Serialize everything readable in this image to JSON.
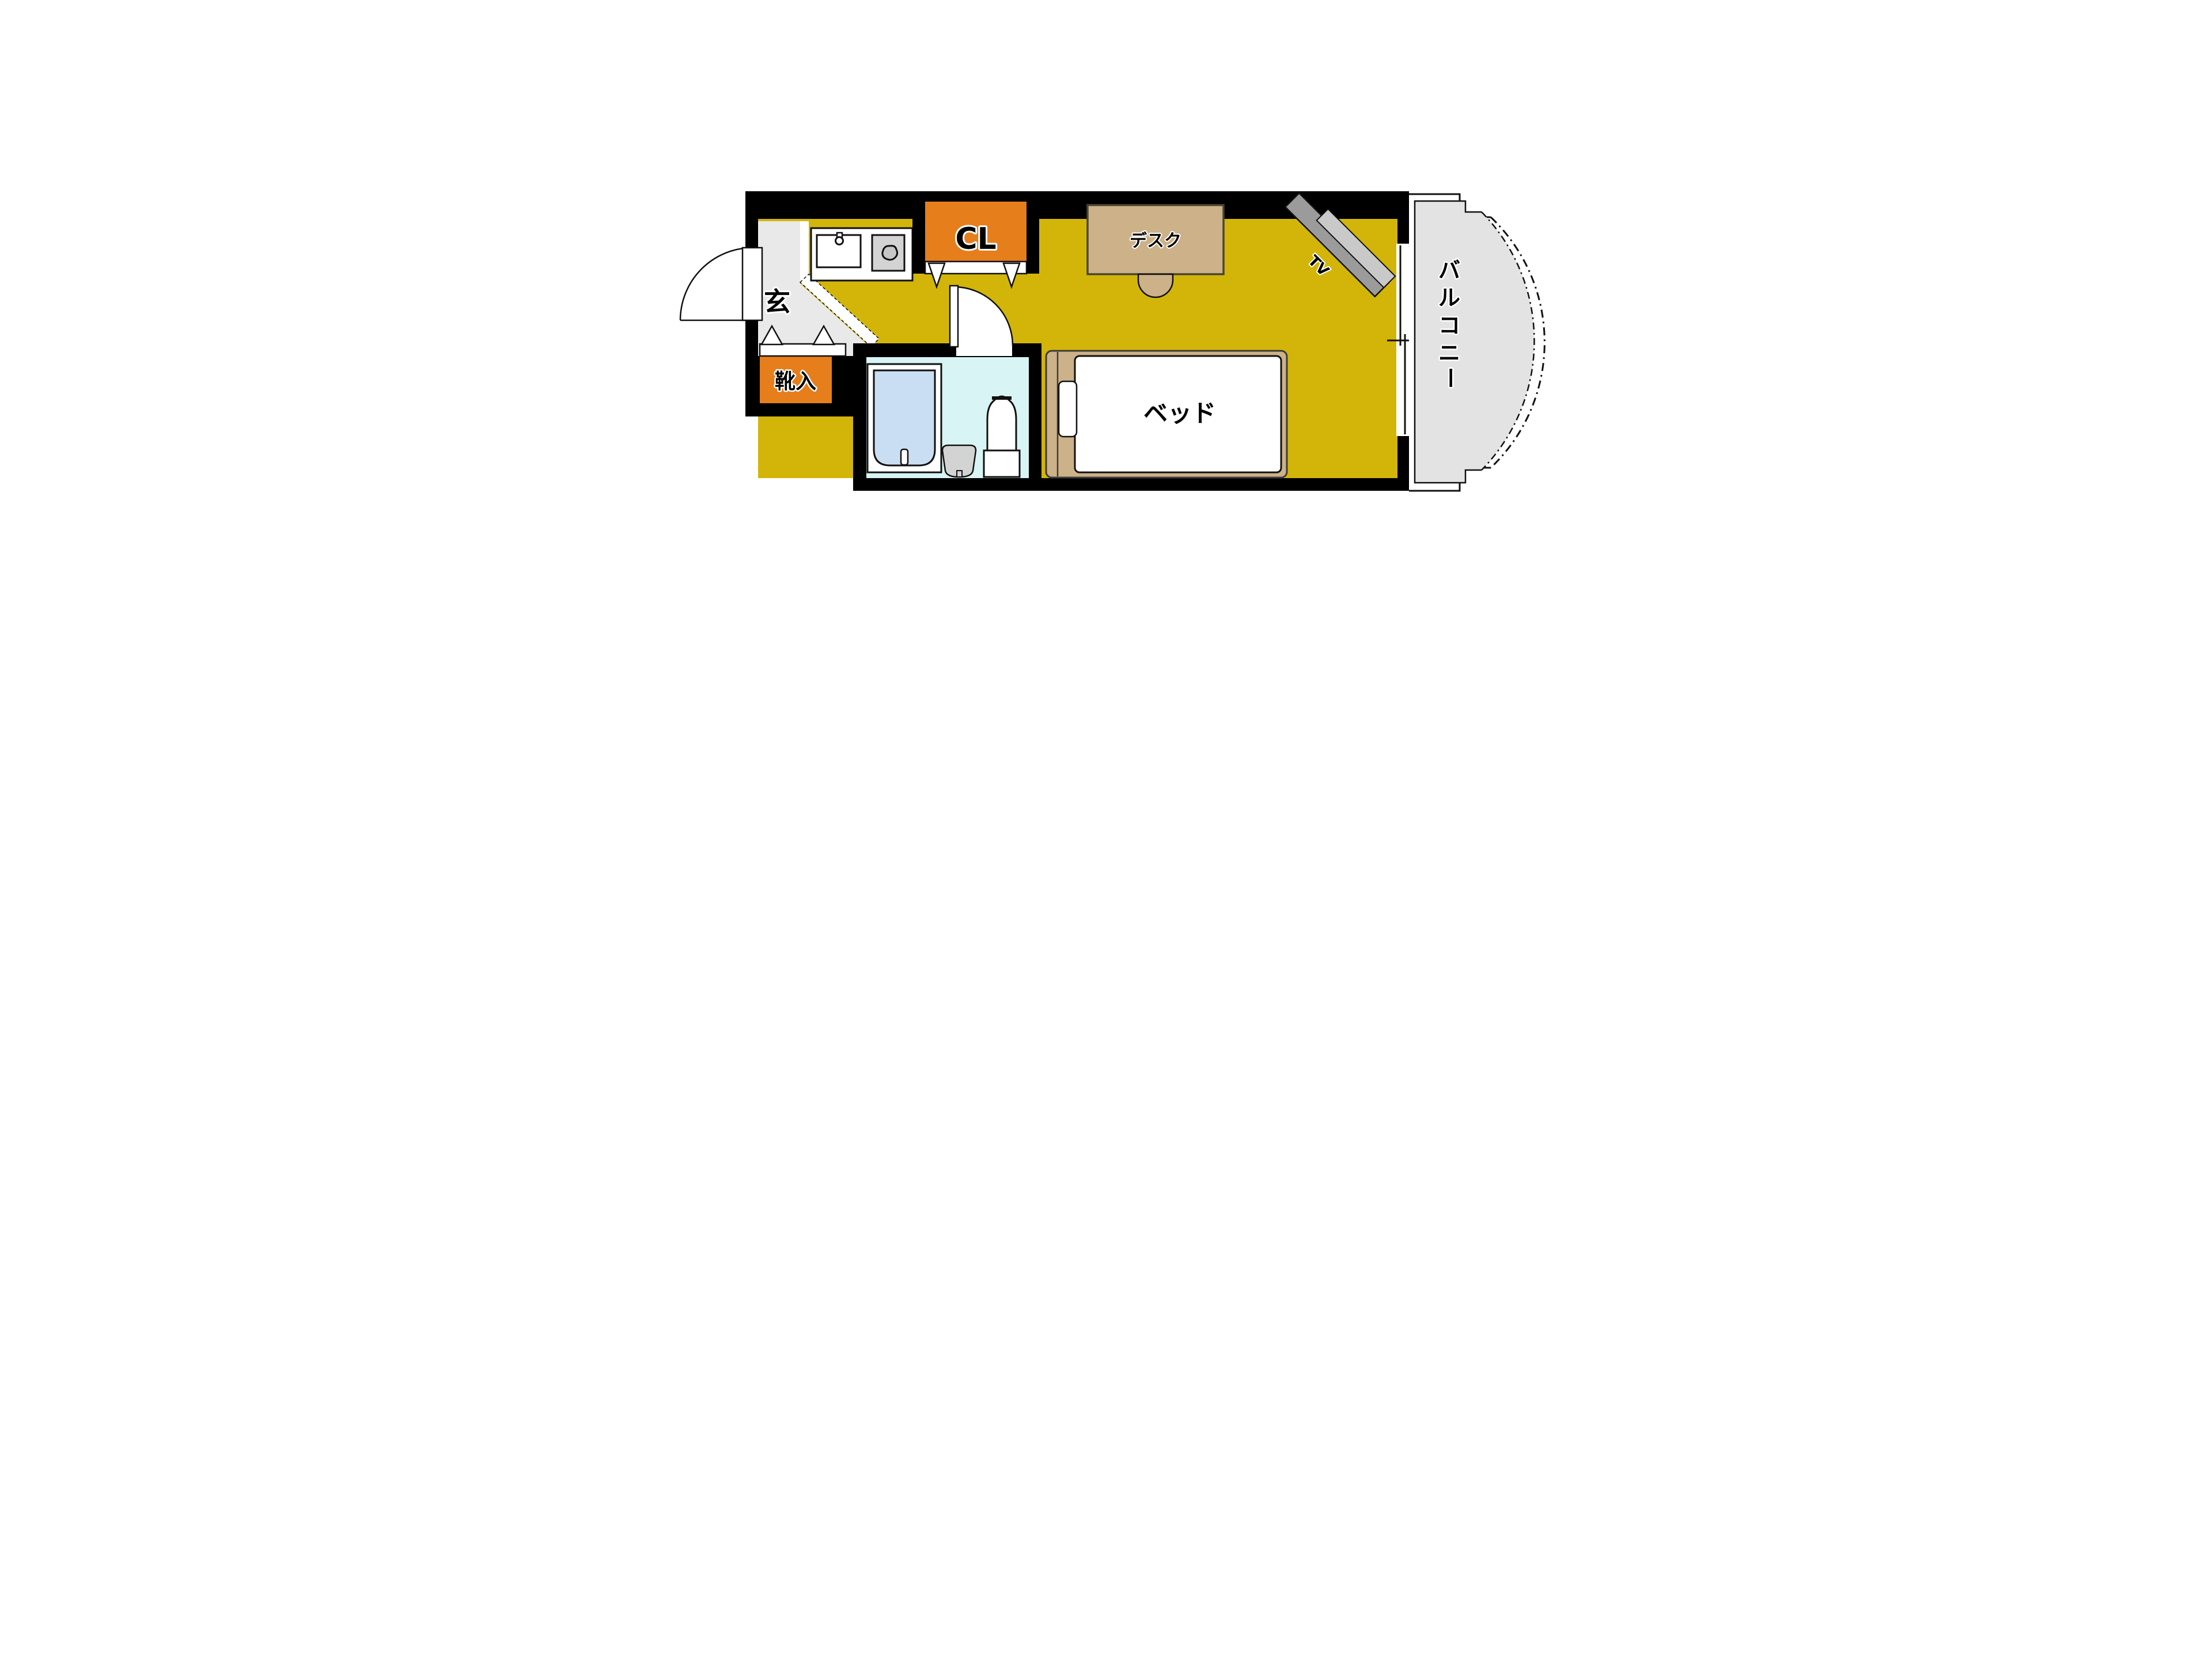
{
  "floorplan": {
    "type": "japanese-apartment-floorplan",
    "labels": {
      "entrance": "玄",
      "shoe_cabinet": "靴入",
      "closet": "CL",
      "desk": "デスク",
      "tv": "TV",
      "bed": "ベッド",
      "balcony": "バルコニー"
    },
    "balcony_chars": [
      "バ",
      "ル",
      "コ",
      "ニ",
      "ー"
    ],
    "colors": {
      "wall": "#000000",
      "floor_yellow": "#d3b50a",
      "accent_orange": "#e67e1b",
      "entrance_gray": "#e9e9e9",
      "balcony_gray": "#e3e3e3",
      "bathroom_cyan": "#d8f4f4",
      "bathtub_blue": "#cadef3",
      "furniture_tan": "#ccb189",
      "tv_dark_gray": "#9b9b9b",
      "tv_light_gray": "#c9c9c9",
      "appliance_gray": "#d3d3d3",
      "mattress_white": "#ffffff"
    }
  }
}
